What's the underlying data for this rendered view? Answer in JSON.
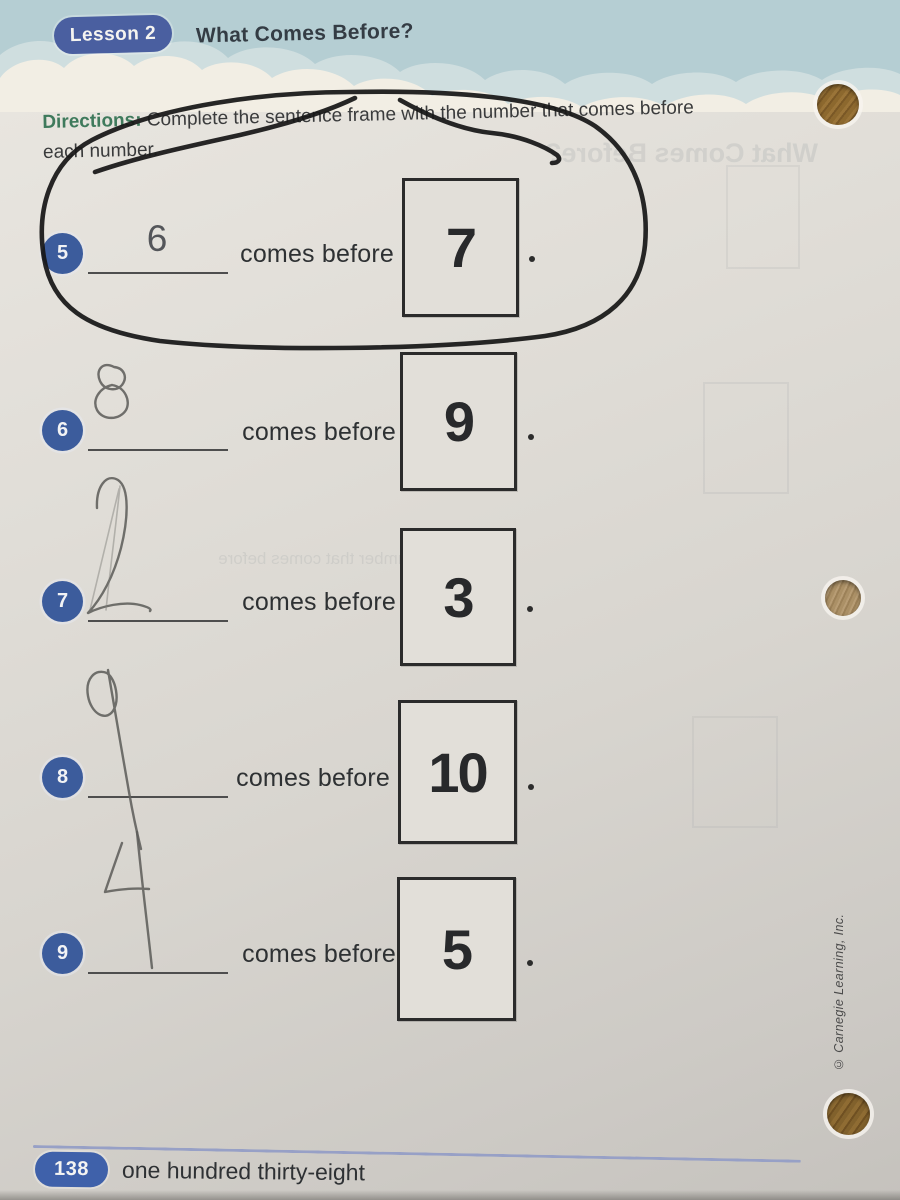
{
  "header": {
    "lesson_badge": "Lesson 2",
    "title": "What Comes Before?"
  },
  "directions": {
    "label": "Directions:",
    "line1": "Complete the sentence frame with the number that comes before",
    "line2": "each number."
  },
  "labels": {
    "comes_before": "comes before",
    "period": "."
  },
  "problems": [
    {
      "number": "5",
      "answer": "6",
      "answer_style": "printed-example",
      "target": "7"
    },
    {
      "number": "6",
      "answer": "8",
      "answer_style": "handwritten-pencil",
      "target": "9"
    },
    {
      "number": "7",
      "answer": "2",
      "answer_style": "handwritten-pencil",
      "target": "3"
    },
    {
      "number": "8",
      "answer": "9",
      "answer_style": "handwritten-pencil",
      "target": "10"
    },
    {
      "number": "9",
      "answer": "4",
      "answer_style": "handwritten-pencil",
      "target": "5"
    }
  ],
  "annotations": {
    "circled_problem": "5",
    "marker_color": "#171717",
    "pencil_color": "#5f5e5b"
  },
  "footer": {
    "page_number": "138",
    "page_word": "one hundred thirty-eight"
  },
  "side": {
    "copyright": "© Carnegie Learning, Inc.",
    "hole_punches": 3
  },
  "ghost_bleedthrough": {
    "title": "What Comes Before?",
    "line": "the number that comes before"
  },
  "colors": {
    "band_blue": "#b5ced3",
    "cloud_cream": "#f2eee4",
    "pill_blue": "#4a5fa0",
    "badge_blue": "#3c5c9c",
    "footer_pill_blue": "#3f61aa",
    "directions_green": "#3f7a5c",
    "paper": "#dcd9d3",
    "footer_line": "#97a0c6"
  }
}
